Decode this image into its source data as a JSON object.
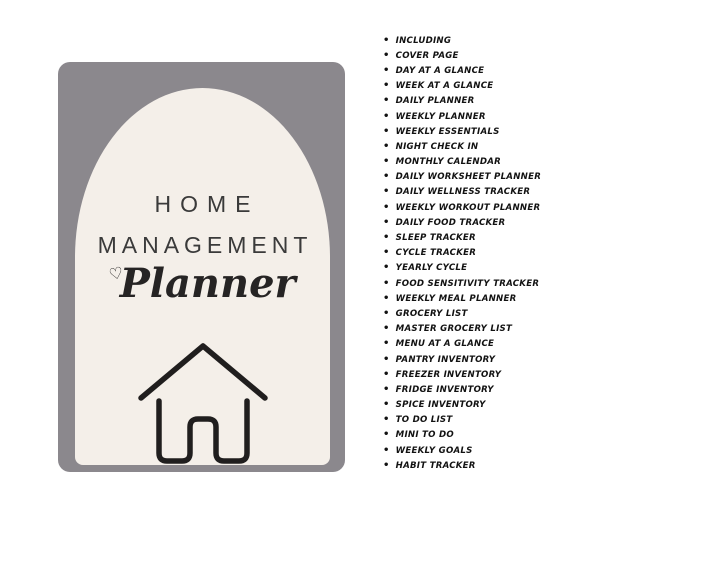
{
  "page": {
    "background_color": "#ffffff"
  },
  "cover": {
    "card_color": "#8b888d",
    "arch_color": "#f4efe9",
    "title_color": "#3a3a3a",
    "icon_color": "#201e1e",
    "title_line1": "HOME",
    "title_line2": "MANAGEMENT",
    "script_word": "Planner",
    "heart_icon": "♡",
    "house_icon": "house-outline-icon"
  },
  "list": {
    "bullet": "•",
    "items": [
      "INCLUDING",
      "COVER PAGE",
      "DAY AT A GLANCE",
      "WEEK AT A GLANCE",
      "DAILY PLANNER",
      "WEEKLY PLANNER",
      "WEEKLY ESSENTIALS",
      "NIGHT CHECK IN",
      "MONTHLY CALENDAR",
      "DAILY WORKSHEET PLANNER",
      "DAILY WELLNESS TRACKER",
      "WEEKLY WORKOUT PLANNER",
      "DAILY FOOD TRACKER",
      "SLEEP TRACKER",
      "CYCLE TRACKER",
      "YEARLY CYCLE",
      "FOOD SENSITIVITY TRACKER",
      "WEEKLY MEAL PLANNER",
      "GROCERY LIST",
      "MASTER GROCERY LIST",
      "MENU AT A GLANCE",
      "PANTRY INVENTORY",
      "FREEZER INVENTORY",
      "FRIDGE INVENTORY",
      "SPICE INVENTORY",
      "TO DO LIST",
      "MINI TO DO",
      "WEEKLY GOALS",
      "HABIT TRACKER"
    ]
  }
}
